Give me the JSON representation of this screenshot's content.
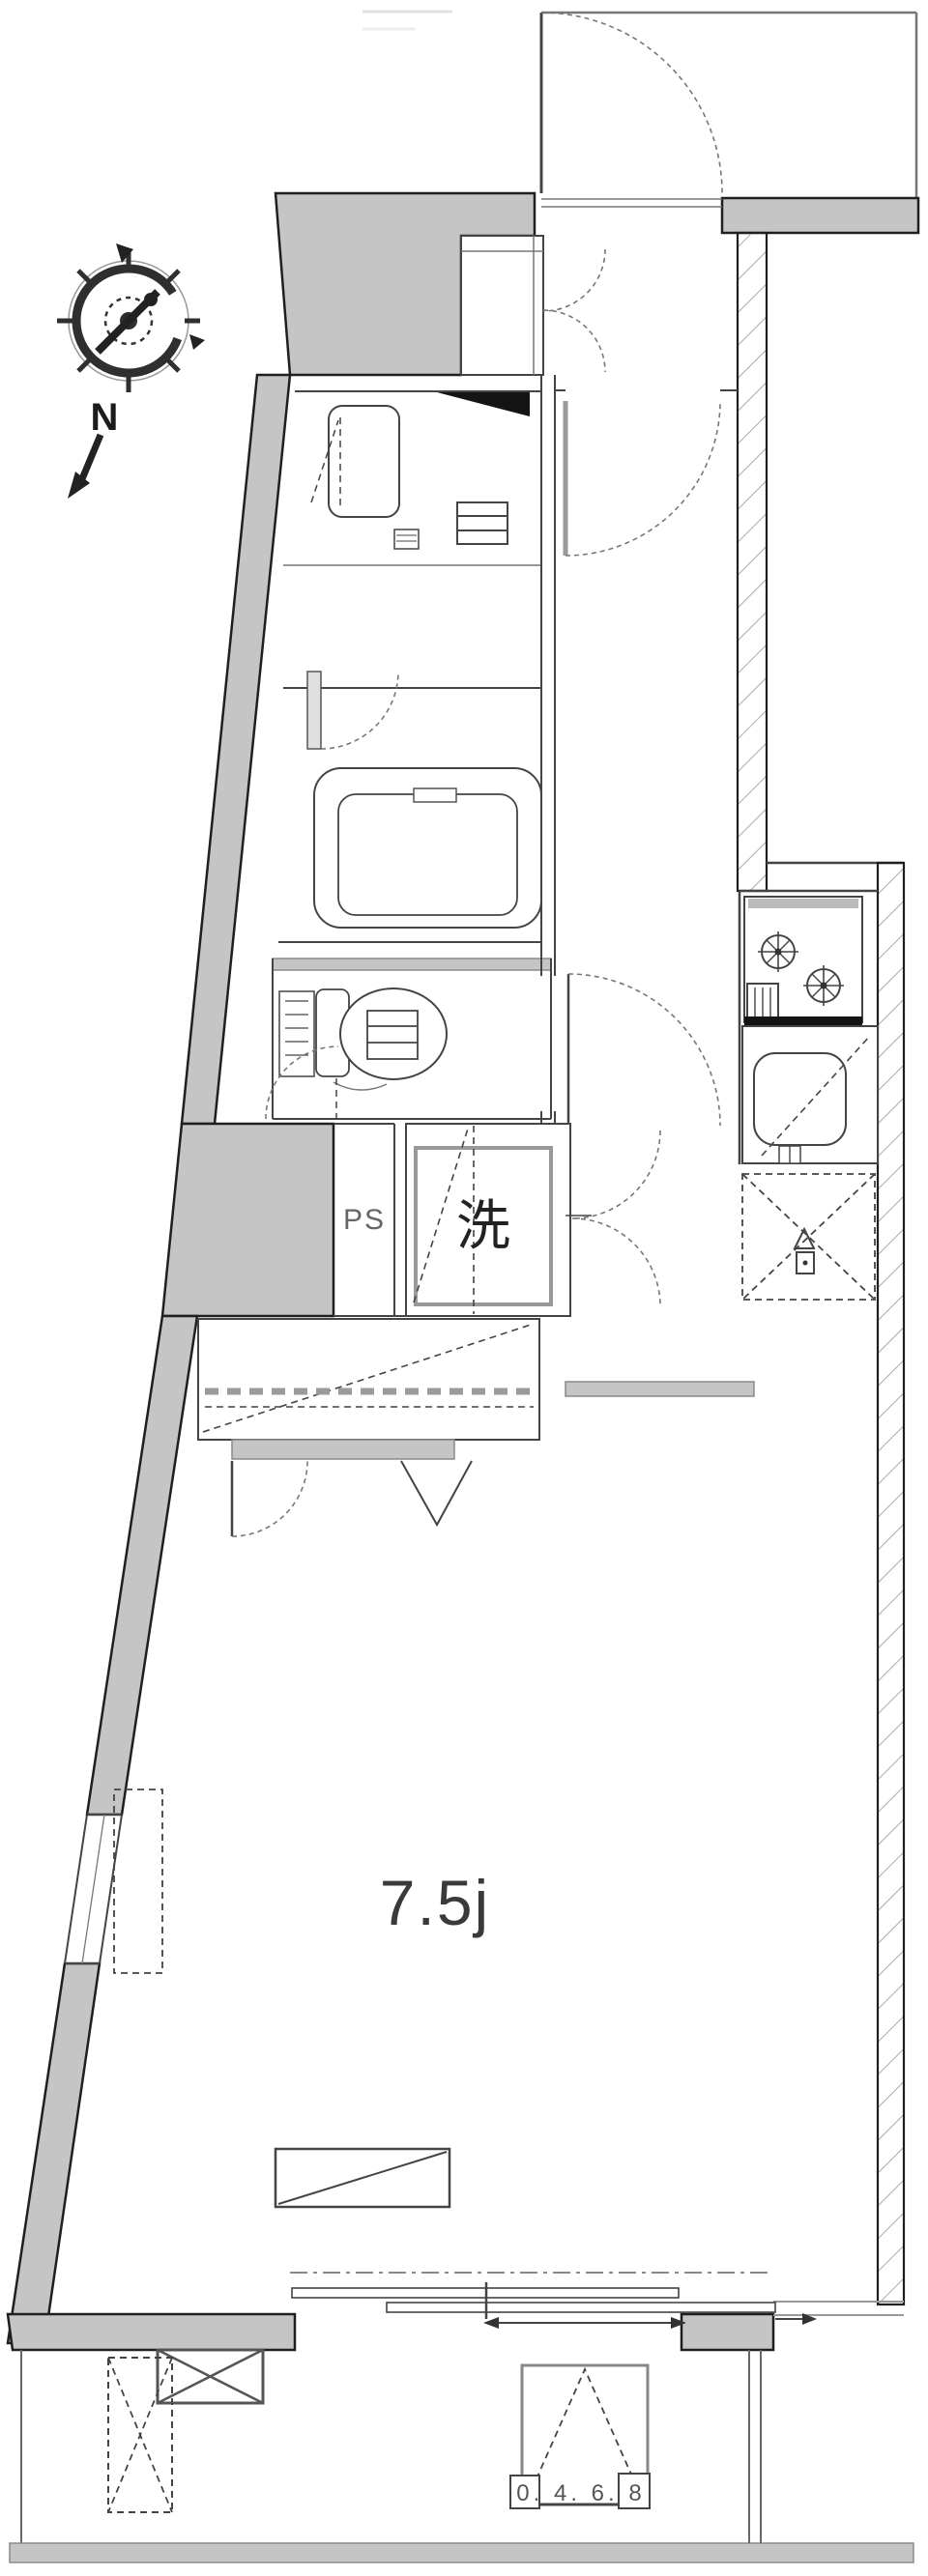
{
  "labels": {
    "main_room": "7.5j",
    "pipe_space": "PS",
    "washing_machine": "洗",
    "compass_north": "N",
    "balcony_hatch": "0. 4. 6. 8"
  },
  "colors": {
    "background": "#ffffff",
    "wall_fill": "#c5c5c5",
    "wall_edge": "#1f1f1f",
    "line": "#444444",
    "door_arc": "#777777",
    "hatch_line": "#aaaaaa",
    "text": "#3a3a3a"
  }
}
